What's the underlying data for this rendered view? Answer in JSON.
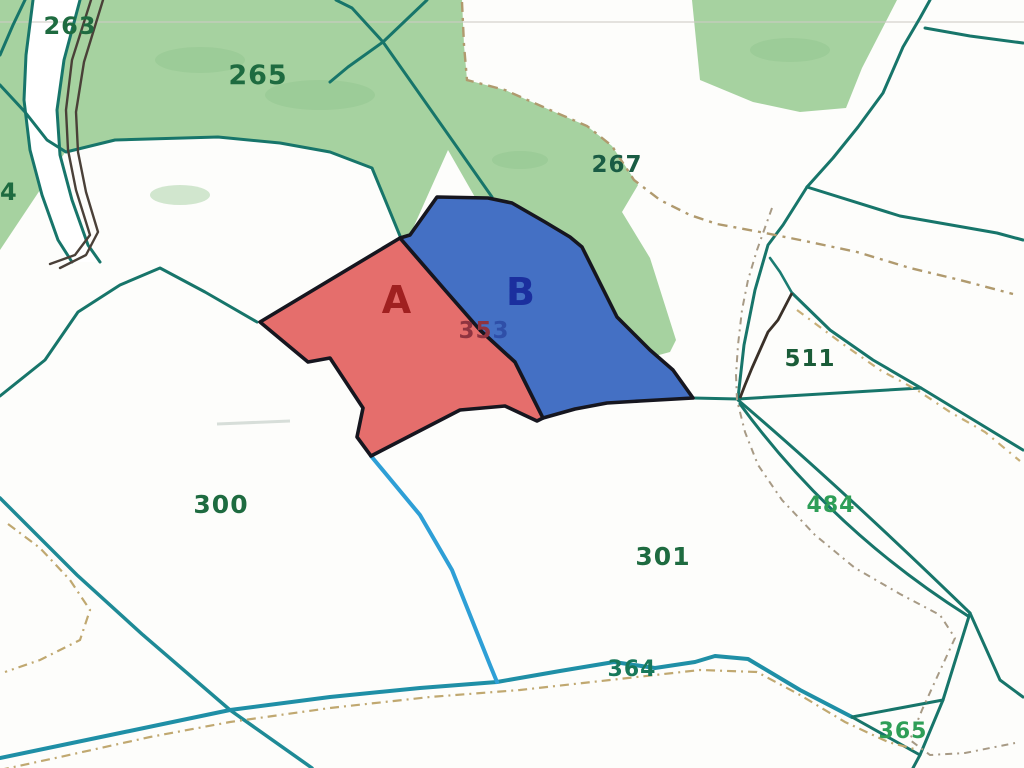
{
  "map": {
    "type": "cadastral-parcel-map",
    "highlighted_parcels": [
      {
        "key": "A",
        "fill": "#E56E6C",
        "label_color": "#A02020"
      },
      {
        "key": "B",
        "fill": "#4470C4",
        "label_color": "#1B2F9E"
      }
    ]
  },
  "labels": {
    "a": "A",
    "b": "B",
    "p353_part1": "35",
    "p353_part2": "3",
    "p263": "263",
    "p265": "265",
    "p267": "267",
    "p300": "300",
    "p301": "301",
    "p364": "364",
    "p365": "365",
    "p4": "4",
    "p484": "484",
    "p511": "511"
  },
  "palette": {
    "parcel_a_fill": "#E56E6C",
    "parcel_b_fill": "#4470C4",
    "parcel_border": "#16161F",
    "green_fill": "#A6D2A0",
    "green_dark": "#8FC48C",
    "label_green_dark": "#1E6B40",
    "label_green_bright": "#2E9E57",
    "label_red": "#A02020",
    "label_blue": "#1B2F9E",
    "number_red": "#8F3440",
    "number_blue": "#2F4FA8",
    "teal_boundary": "#17756A",
    "road_blue": "#1F8FA6",
    "stream_cyan": "#2E9FD6",
    "dashed_tan": "#B09A6E",
    "dark_casing": "#4A4038",
    "background": "#FFFFFF"
  }
}
